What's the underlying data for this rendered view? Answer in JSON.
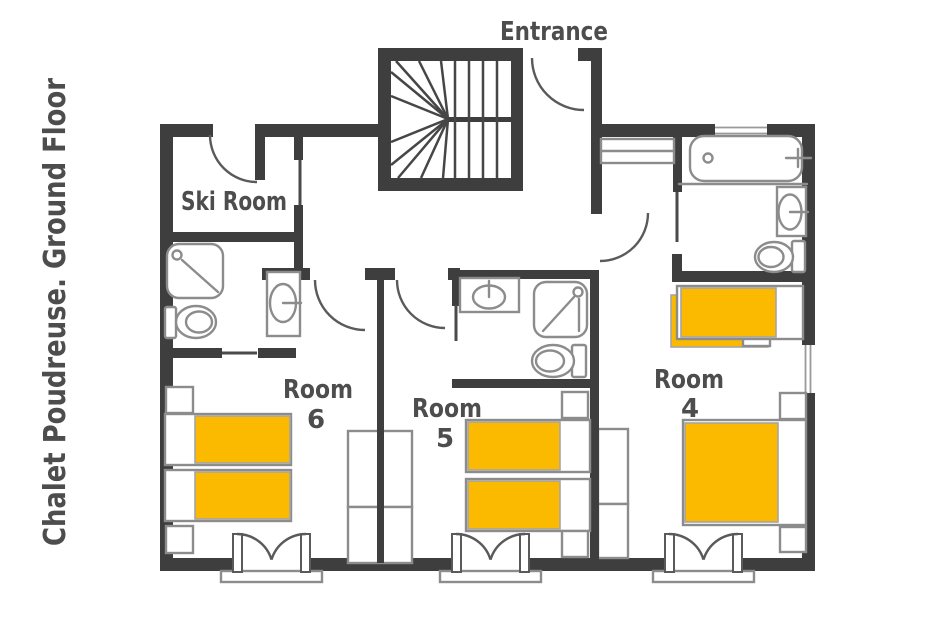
{
  "title": "Chalet Poudreuse. Ground Floor",
  "labels": {
    "entrance": "Entrance",
    "ski_room": "Ski Room",
    "room6": {
      "name": "Room",
      "number": "6"
    },
    "room5": {
      "name": "Room",
      "number": "5"
    },
    "room4": {
      "name": "Room",
      "number": "4"
    }
  },
  "colors": {
    "wall": "#3E3E3E",
    "bed": "#FBB900",
    "text": "#4D4D4D",
    "fixture_outline": "#8C8C8C",
    "door_arc": "#5A5A5A"
  }
}
